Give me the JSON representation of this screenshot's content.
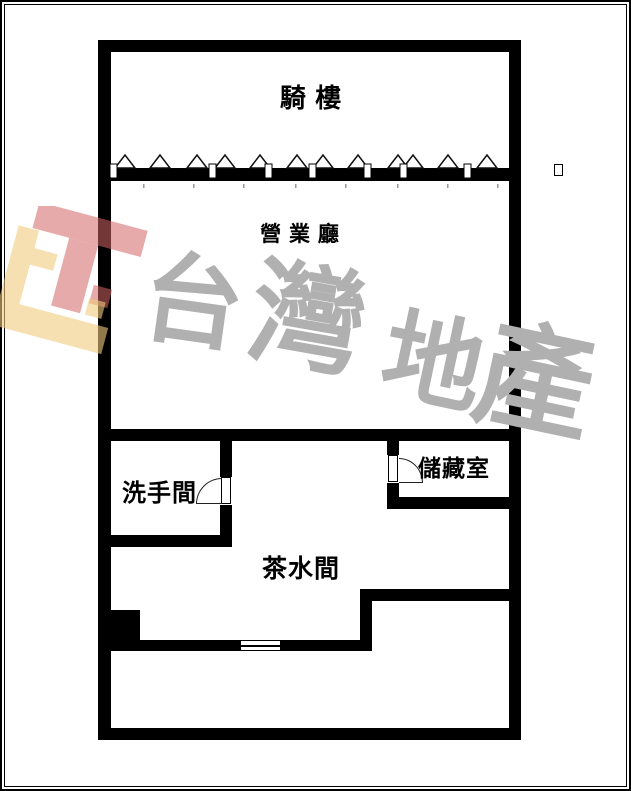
{
  "plan": {
    "rooms": [
      {
        "id": "arcade",
        "label": "騎 樓"
      },
      {
        "id": "hall",
        "label": "營 業 廳"
      },
      {
        "id": "washroom",
        "label": "洗手間"
      },
      {
        "id": "storage",
        "label": "儲藏室"
      },
      {
        "id": "pantry",
        "label": "茶水間"
      }
    ],
    "symbols": {
      "fence_triangle_row": "open-triangle-fence-on-arcade-wall",
      "doors": [
        "washroom-swing-door",
        "storage-swing-door"
      ],
      "window": "pantry-double-line-window",
      "unknown_glyph_box": "small-empty-rectangle-right-margin"
    }
  },
  "watermark": {
    "text": "台灣地產",
    "chars": [
      "台",
      "灣",
      "地",
      "產"
    ],
    "text_color": "#b0b0b0",
    "logo_colors": {
      "red": "#d46464",
      "yellow": "#f0ca7d"
    }
  },
  "colors": {
    "wall": "#000000",
    "background": "#ffffff",
    "frame": "#000000"
  }
}
